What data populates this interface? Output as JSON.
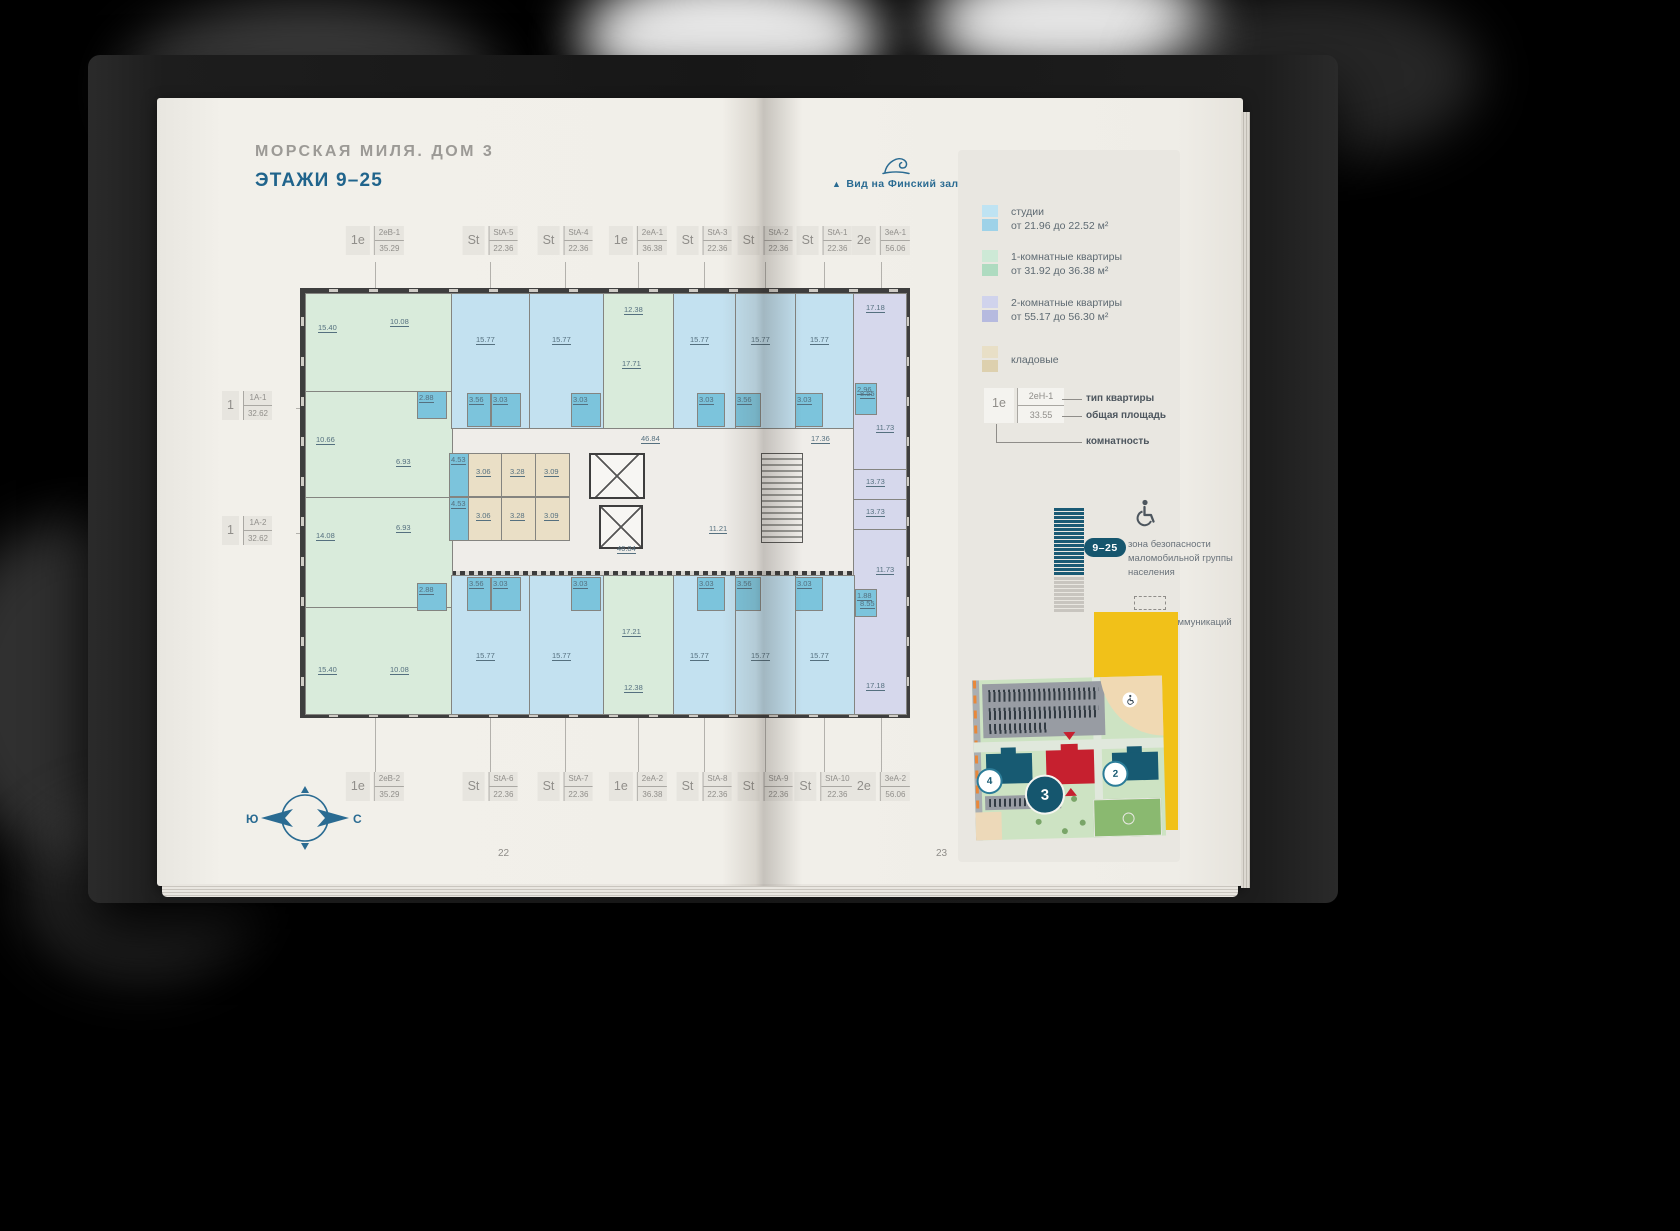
{
  "book": {
    "left_page_number": "22",
    "right_page_number": "23"
  },
  "left_page": {
    "title": "МОРСКАЯ МИЛЯ. ДОМ 3",
    "subtitle": "ЭТАЖИ 9–25",
    "compass": {
      "west": "Ю",
      "east": "С"
    }
  },
  "right_page": {
    "view_marker": "▲",
    "view_label": "Вид на Финский залив",
    "legend": [
      {
        "name": "studios",
        "color1": "#bfe3f2",
        "color2": "#9ed2e8",
        "line1": "студии",
        "line2": "от 21.96 до 22.52 м²"
      },
      {
        "name": "one-room",
        "color1": "#cde9d6",
        "color2": "#aedbc0",
        "line1": "1-комнатные квартиры",
        "line2": "от 31.92 до 36.38 м²"
      },
      {
        "name": "two-room",
        "color1": "#d0d3ec",
        "color2": "#b6badf",
        "line1": "2-комнатные квартиры",
        "line2": "от 55.17 до 56.30 м²"
      },
      {
        "name": "storage",
        "color1": "#e8dfc6",
        "color2": "#ddd0ae",
        "line1": "кладовые",
        "line2": ""
      }
    ],
    "callout": {
      "rooms": "1е",
      "type": "2еН-1",
      "area": "33.55",
      "label_type": "тип квартиры",
      "label_area": "общая площадь",
      "label_rooms": "комнатность"
    },
    "floors_badge": "9–25",
    "accessibility_note": "зона безопасности маломобильной группы населения",
    "communications_note": "зашивка коммуникаций",
    "site_map": {
      "building_far": "4",
      "building_active": "3",
      "building_near": "2"
    }
  },
  "floor_plan": {
    "top_labels": [
      {
        "rooms": "1е",
        "type": "2еВ-1",
        "area": "35.29",
        "cx": 70
      },
      {
        "rooms": "St",
        "type": "StA-5",
        "area": "22.36",
        "cx": 185
      },
      {
        "rooms": "St",
        "type": "StA-4",
        "area": "22.36",
        "cx": 260
      },
      {
        "rooms": "1е",
        "type": "2еА-1",
        "area": "36.38",
        "cx": 333
      },
      {
        "rooms": "St",
        "type": "StA-3",
        "area": "22.36",
        "cx": 399
      },
      {
        "rooms": "St",
        "type": "StA-2",
        "area": "22.36",
        "cx": 460
      },
      {
        "rooms": "St",
        "type": "StA-1",
        "area": "22.36",
        "cx": 519
      },
      {
        "rooms": "2е",
        "type": "3еА-1",
        "area": "56.06",
        "cx": 576
      }
    ],
    "bottom_labels": [
      {
        "rooms": "1е",
        "type": "2еВ-2",
        "area": "35.29",
        "cx": 70
      },
      {
        "rooms": "St",
        "type": "StA-6",
        "area": "22.36",
        "cx": 185
      },
      {
        "rooms": "St",
        "type": "StA-7",
        "area": "22.36",
        "cx": 260
      },
      {
        "rooms": "1е",
        "type": "2еА-2",
        "area": "36.38",
        "cx": 333
      },
      {
        "rooms": "St",
        "type": "StA-8",
        "area": "22.36",
        "cx": 399
      },
      {
        "rooms": "St",
        "type": "StA-9",
        "area": "22.36",
        "cx": 460
      },
      {
        "rooms": "St",
        "type": "StA-10",
        "area": "22.36",
        "cx": 519
      },
      {
        "rooms": "2е",
        "type": "3еА-2",
        "area": "56.06",
        "cx": 576
      }
    ],
    "side_labels": [
      {
        "rooms": "1",
        "type": "1А-1",
        "area": "32.62",
        "cy": 115
      },
      {
        "rooms": "1",
        "type": "1А-2",
        "area": "32.62",
        "cy": 240
      }
    ],
    "units": [
      {
        "cls": "u-green",
        "x": 0,
        "y": 0,
        "w": 146,
        "h": 98,
        "labels": [
          {
            "t": "15.40",
            "x": 12,
            "y": 30
          },
          {
            "t": "10.08",
            "x": 84,
            "y": 24
          }
        ]
      },
      {
        "cls": "u-green",
        "x": 0,
        "y": 98,
        "w": 146,
        "h": 106,
        "labels": [
          {
            "t": "10.66",
            "x": 10,
            "y": 44
          },
          {
            "t": "6.93",
            "x": 90,
            "y": 66
          }
        ]
      },
      {
        "cls": "u-green",
        "x": 0,
        "y": 204,
        "w": 146,
        "h": 110,
        "labels": [
          {
            "t": "14.08",
            "x": 10,
            "y": 34
          },
          {
            "t": "6.93",
            "x": 90,
            "y": 26
          }
        ]
      },
      {
        "cls": "u-green",
        "x": 0,
        "y": 314,
        "w": 146,
        "h": 106,
        "labels": [
          {
            "t": "15.40",
            "x": 12,
            "y": 58
          },
          {
            "t": "10.08",
            "x": 84,
            "y": 58
          }
        ]
      },
      {
        "cls": "u-blue",
        "x": 146,
        "y": 0,
        "w": 78,
        "h": 134,
        "labels": [
          {
            "t": "15.77",
            "x": 24,
            "y": 42
          }
        ]
      },
      {
        "cls": "u-blue",
        "x": 224,
        "y": 0,
        "w": 74,
        "h": 134,
        "labels": [
          {
            "t": "15.77",
            "x": 22,
            "y": 42
          }
        ]
      },
      {
        "cls": "u-green",
        "x": 298,
        "y": 0,
        "w": 70,
        "h": 134,
        "labels": [
          {
            "t": "12.38",
            "x": 20,
            "y": 12
          },
          {
            "t": "17.71",
            "x": 18,
            "y": 66
          }
        ]
      },
      {
        "cls": "u-blue",
        "x": 368,
        "y": 0,
        "w": 62,
        "h": 134,
        "labels": [
          {
            "t": "15.77",
            "x": 16,
            "y": 42
          }
        ]
      },
      {
        "cls": "u-blue",
        "x": 430,
        "y": 0,
        "w": 60,
        "h": 134,
        "labels": [
          {
            "t": "15.77",
            "x": 15,
            "y": 42
          }
        ]
      },
      {
        "cls": "u-blue",
        "x": 490,
        "y": 0,
        "w": 58,
        "h": 134,
        "labels": [
          {
            "t": "15.77",
            "x": 14,
            "y": 42
          }
        ]
      },
      {
        "cls": "u-purple",
        "x": 548,
        "y": 0,
        "w": 52,
        "h": 176,
        "labels": [
          {
            "t": "17.18",
            "x": 12,
            "y": 10
          },
          {
            "t": "8.55",
            "x": 6,
            "y": 96
          },
          {
            "t": "11.73",
            "x": 22,
            "y": 130
          }
        ]
      },
      {
        "cls": "u-purple",
        "x": 548,
        "y": 176,
        "w": 52,
        "h": 30,
        "labels": [
          {
            "t": "13.73",
            "x": 12,
            "y": 8
          }
        ]
      },
      {
        "cls": "u-purple",
        "x": 548,
        "y": 206,
        "w": 52,
        "h": 30,
        "labels": [
          {
            "t": "13.73",
            "x": 12,
            "y": 8
          }
        ]
      },
      {
        "cls": "u-purple",
        "x": 548,
        "y": 236,
        "w": 52,
        "h": 184,
        "labels": [
          {
            "t": "11.73",
            "x": 22,
            "y": 36
          },
          {
            "t": "8.55",
            "x": 6,
            "y": 70
          },
          {
            "t": "17.18",
            "x": 12,
            "y": 152
          }
        ]
      },
      {
        "cls": "u-blue",
        "x": 146,
        "y": 282,
        "w": 78,
        "h": 138,
        "labels": [
          {
            "t": "15.77",
            "x": 24,
            "y": 76
          }
        ]
      },
      {
        "cls": "u-blue",
        "x": 224,
        "y": 282,
        "w": 74,
        "h": 138,
        "labels": [
          {
            "t": "15.77",
            "x": 22,
            "y": 76
          }
        ]
      },
      {
        "cls": "u-green",
        "x": 298,
        "y": 282,
        "w": 70,
        "h": 138,
        "labels": [
          {
            "t": "17.21",
            "x": 18,
            "y": 52
          },
          {
            "t": "12.38",
            "x": 20,
            "y": 108
          }
        ]
      },
      {
        "cls": "u-blue",
        "x": 368,
        "y": 282,
        "w": 62,
        "h": 138,
        "labels": [
          {
            "t": "15.77",
            "x": 16,
            "y": 76
          }
        ]
      },
      {
        "cls": "u-blue",
        "x": 430,
        "y": 282,
        "w": 60,
        "h": 138,
        "labels": [
          {
            "t": "15.77",
            "x": 15,
            "y": 76
          }
        ]
      },
      {
        "cls": "u-blue",
        "x": 490,
        "y": 282,
        "w": 58,
        "h": 138,
        "labels": [
          {
            "t": "15.77",
            "x": 14,
            "y": 76
          }
        ]
      },
      {
        "cls": "u-beige",
        "x": 162,
        "y": 160,
        "w": 33,
        "h": 42,
        "labels": [
          {
            "t": "3.06",
            "x": 8,
            "y": 14
          }
        ]
      },
      {
        "cls": "u-beige",
        "x": 196,
        "y": 160,
        "w": 33,
        "h": 42,
        "labels": [
          {
            "t": "3.28",
            "x": 8,
            "y": 14
          }
        ]
      },
      {
        "cls": "u-beige",
        "x": 230,
        "y": 160,
        "w": 33,
        "h": 42,
        "labels": [
          {
            "t": "3.09",
            "x": 8,
            "y": 14
          }
        ]
      },
      {
        "cls": "u-beige",
        "x": 162,
        "y": 204,
        "w": 33,
        "h": 42,
        "labels": [
          {
            "t": "3.06",
            "x": 8,
            "y": 14
          }
        ]
      },
      {
        "cls": "u-beige",
        "x": 196,
        "y": 204,
        "w": 33,
        "h": 42,
        "labels": [
          {
            "t": "3.28",
            "x": 8,
            "y": 14
          }
        ]
      },
      {
        "cls": "u-beige",
        "x": 230,
        "y": 204,
        "w": 33,
        "h": 42,
        "labels": [
          {
            "t": "3.09",
            "x": 8,
            "y": 14
          }
        ]
      }
    ],
    "small_rooms": [
      {
        "t": "3.56",
        "x": 162,
        "y": 100,
        "w": 22,
        "h": 32
      },
      {
        "t": "3.03",
        "x": 186,
        "y": 100,
        "w": 28,
        "h": 32
      },
      {
        "t": "3.03",
        "x": 266,
        "y": 100,
        "w": 28,
        "h": 32
      },
      {
        "t": "3.03",
        "x": 392,
        "y": 100,
        "w": 26,
        "h": 32
      },
      {
        "t": "3.56",
        "x": 430,
        "y": 100,
        "w": 24,
        "h": 32
      },
      {
        "t": "3.03",
        "x": 490,
        "y": 100,
        "w": 26,
        "h": 32
      },
      {
        "t": "3.56",
        "x": 162,
        "y": 284,
        "w": 22,
        "h": 32
      },
      {
        "t": "3.03",
        "x": 186,
        "y": 284,
        "w": 28,
        "h": 32
      },
      {
        "t": "3.03",
        "x": 266,
        "y": 284,
        "w": 28,
        "h": 32
      },
      {
        "t": "3.03",
        "x": 392,
        "y": 284,
        "w": 26,
        "h": 32
      },
      {
        "t": "3.56",
        "x": 430,
        "y": 284,
        "w": 24,
        "h": 32
      },
      {
        "t": "3.03",
        "x": 490,
        "y": 284,
        "w": 26,
        "h": 32
      },
      {
        "t": "2.88",
        "x": 112,
        "y": 98,
        "w": 28,
        "h": 26
      },
      {
        "t": "2.88",
        "x": 112,
        "y": 290,
        "w": 28,
        "h": 26
      },
      {
        "t": "4.53",
        "x": 144,
        "y": 160,
        "w": 18,
        "h": 42
      },
      {
        "t": "4.53",
        "x": 144,
        "y": 204,
        "w": 18,
        "h": 42
      },
      {
        "t": "2.96",
        "x": 550,
        "y": 90,
        "w": 20,
        "h": 30
      },
      {
        "t": "1.88",
        "x": 550,
        "y": 296,
        "w": 20,
        "h": 26
      }
    ],
    "corridor_labels": [
      {
        "t": "46.84",
        "x": 336,
        "y": 142
      },
      {
        "t": "46.84",
        "x": 312,
        "y": 252
      },
      {
        "t": "11.21",
        "x": 404,
        "y": 232
      },
      {
        "t": "17.36",
        "x": 506,
        "y": 142
      }
    ]
  }
}
